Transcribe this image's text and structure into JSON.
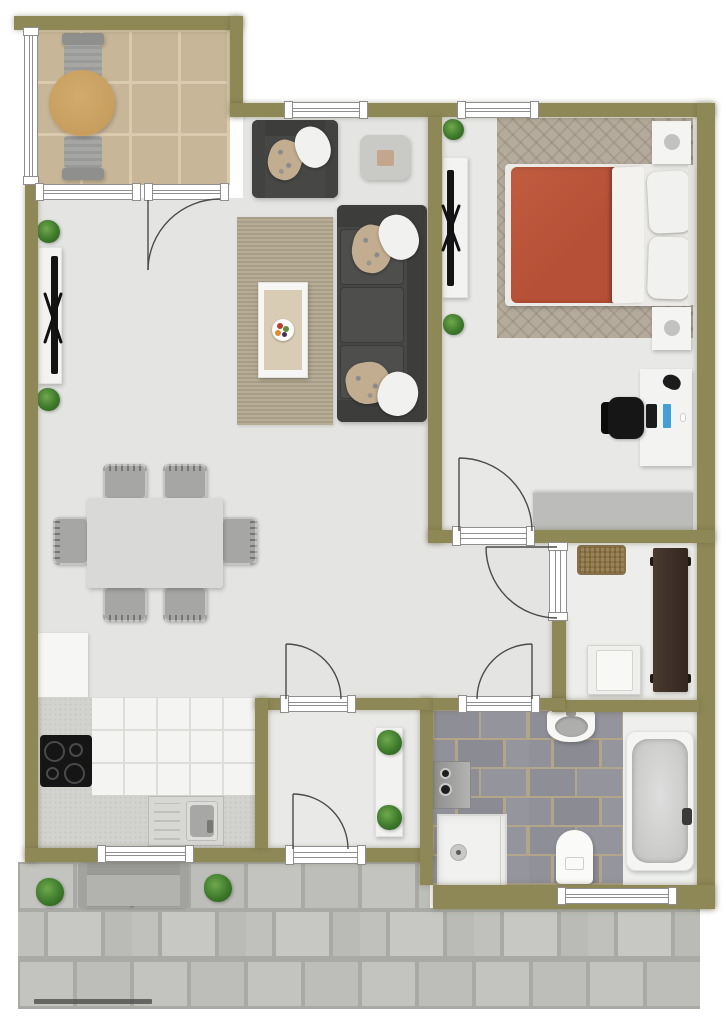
{
  "title": "apartment-floor-plan",
  "watermark": {
    "text": ""
  },
  "palette": {
    "wall": "#8e8857",
    "floor_living": "#e4e4e2",
    "floor_bedroom": "#e8e8e6",
    "floor_hall": "#ededeb",
    "floor_vestibule": "#e9e9e7",
    "floor_bath_white": "#eff0ee",
    "balcony_tile": "#c8b698",
    "balcony_grout": "#dacbae",
    "outdoor_table": "#c79e5e",
    "chair_gray": "#a6a6a4",
    "sofa": "#474745",
    "sofa_dark": "#3d3d3b",
    "pillow_white": "#f1f1ef",
    "pillow_pattern": "#c3ad90",
    "rug_living": "#b1a58d",
    "rug_inner": "#d8ccb4",
    "rug_bedroom": "#b4ab9c",
    "dining_table": "#d9d9d7",
    "console_white": "#f3f3f1",
    "tv_black": "#141414",
    "duvet_orange": "#b65137",
    "bed_frame": "#eceae6",
    "dresser_gray": "#bcbcba",
    "office_chair": "#161616",
    "accent_blue": "#449fd8",
    "wardrobe_brown": "#40322a",
    "doormat_brown": "#9c8355",
    "appliance_white": "#efefec",
    "counter_gray": "#d2d2ce",
    "cooktop_black": "#151515",
    "kitchen_tile": "#f4f4f2",
    "kitchen_grout": "#ddddda",
    "sink_steel": "#d7d7d4",
    "bath_tile": "#8e8e96",
    "bath_grout": "#b1a58c",
    "tub_white": "#f5f5f3",
    "tub_inner": "#c9c9c7",
    "washer_gray": "#9f9f9d",
    "paving_stone": "#c3c4bf",
    "paving_gap": "#a9aaa6",
    "bench_gray": "#b2b3af",
    "plant_green": "#3e7a2c",
    "line_door": "#4b4b4b",
    "window_line": "#8f8f8f"
  },
  "rooms": [
    "balcony",
    "living-dining-room",
    "kitchen",
    "bedroom",
    "hallway",
    "vestibule",
    "bathroom",
    "patio"
  ],
  "inventory": {
    "balcony": [
      "round-outdoor-table",
      "outdoor-chair-north",
      "outdoor-chair-south"
    ],
    "living_dining": [
      "armchair",
      "side-table",
      "sofa-3-seat",
      "area-rug",
      "coffee-table",
      "fruit-bowl",
      "dining-table",
      "dining-chairs-x6",
      "tv-console",
      "tv",
      "plants-x2"
    ],
    "kitchen": [
      "white-cabinet",
      "l-shaped-counter",
      "cooktop-4-burner",
      "sink-with-drainboard",
      "tile-floor",
      "window"
    ],
    "bedroom": [
      "double-bed",
      "duvet",
      "pillows-x2",
      "nightstand-x2",
      "herringbone-rug",
      "tv-console",
      "tv",
      "desk",
      "monitor",
      "office-chair",
      "headphones",
      "dresser",
      "plants-x2"
    ],
    "hallway": [
      "doormat",
      "wardrobe",
      "white-cabinet"
    ],
    "vestibule": [
      "console-shelf",
      "plants-x2"
    ],
    "bathroom": [
      "pedestal-sink",
      "washing-machine",
      "shower",
      "toilet",
      "bathtub",
      "window"
    ],
    "patio": [
      "stone-paving",
      "garden-bench",
      "bushes-x2"
    ]
  },
  "doors": [
    "balcony-door",
    "bedroom-door",
    "hallway-door",
    "bathroom-door",
    "vestibule-interior-door",
    "vestibule-exterior-door"
  ],
  "windows": [
    "balcony-side-window",
    "balcony-front-window",
    "living-top-window",
    "bedroom-top-window",
    "kitchen-window",
    "bathroom-window"
  ]
}
